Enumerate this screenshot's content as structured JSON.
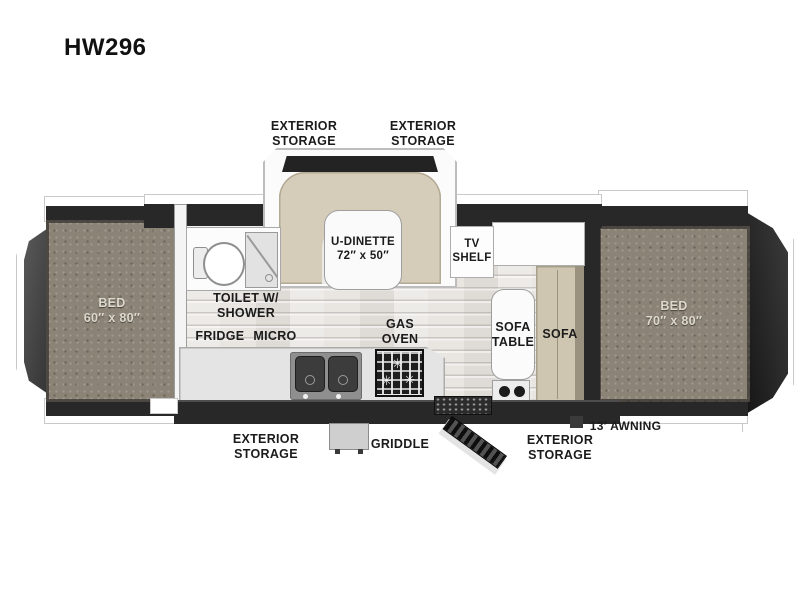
{
  "model": "HW296",
  "exterior_callouts": {
    "storage_front_left": "EXTERIOR\nSTORAGE",
    "storage_front_right": "EXTERIOR\nSTORAGE",
    "storage_rear_left": "EXTERIOR\nSTORAGE",
    "storage_rear_right": "EXTERIOR\nSTORAGE",
    "griddle": "GRIDDLE",
    "awning": "13′ AWNING"
  },
  "interior": {
    "dinette_label": "U-DINETTE\n72″ x 50″",
    "tv_shelf_label": "TV\nSHELF",
    "bath_label": "TOILET W/\nSHOWER",
    "fridge_label": "FRIDGE",
    "micro_label": "MICRO",
    "range_label": "GAS\nOVEN",
    "sofa_table_label": "SOFA\nTABLE",
    "sofa_label": "SOFA",
    "bed_left_label": "BED\n60″ x 80″",
    "bed_right_label": "BED\n70″ x 80″"
  },
  "colors": {
    "wall": "#282828",
    "bench_tan": "#d5ccb9",
    "mattress_gray": "#8b8376",
    "floor_wood": "#e9e6e2",
    "counter_gray": "#e4e4e4"
  }
}
